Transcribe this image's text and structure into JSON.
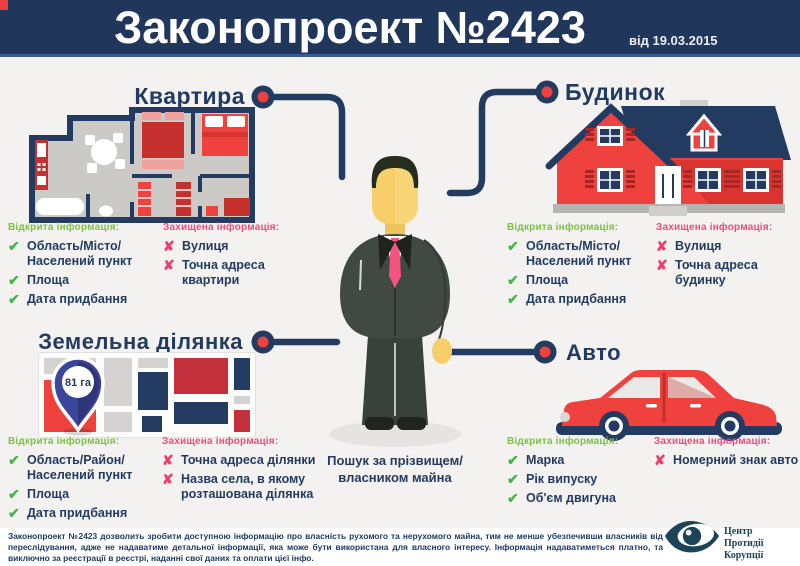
{
  "header": {
    "title": "Законопроект №2423",
    "date": "від 19.03.2015"
  },
  "sections": [
    {
      "id": "apartment",
      "title": "Квартира",
      "open_heading": "Відкрита інформація:",
      "open_items": [
        "Область/Місто/\nНаселений пункт",
        "Площа",
        "Дата придбання"
      ],
      "protected_heading": "Захищена інформація:",
      "protected_items": [
        "Вулиця",
        "Точна адреса квартири"
      ]
    },
    {
      "id": "house",
      "title": "Будинок",
      "open_heading": "Відкрита інформація:",
      "open_items": [
        "Область/Місто/\nНаселений пункт",
        "Площа",
        "Дата придбання"
      ],
      "protected_heading": "Захищена інформація:",
      "protected_items": [
        "Вулиця",
        "Точна адреса будинку"
      ]
    },
    {
      "id": "land",
      "title": "Земельна ділянка",
      "open_heading": "Відкрита інформація:",
      "open_items": [
        "Область/Район/\nНаселений пункт",
        "Площа",
        "Дата придбання"
      ],
      "protected_heading": "Захищена інформація:",
      "protected_items": [
        "Точна адреса ділянки",
        "Назва села, в якому\nрозташована ділянка"
      ]
    },
    {
      "id": "auto",
      "title": "Авто",
      "open_heading": "Відкрита інформація:",
      "open_items": [
        "Марка",
        "Рік випуску",
        "Об'єм двигуна"
      ],
      "protected_heading": "Захищена інформація:",
      "protected_items": [
        "Номерний знак авто"
      ]
    }
  ],
  "center": {
    "caption": "Пошук за прізвищем/\nвласником майна"
  },
  "land_map": {
    "pin_label": "81 га"
  },
  "icons": {
    "check": "✔",
    "cross": "✘",
    "logo": "eye-icon"
  },
  "footer": {
    "text": "Законопроект №2423 дозволить зробити доступною інформацію про власність рухомого та нерухомого майна, тим не менше убезпечивши власників від переслідування, адже не надаватиме детальної інформації, яка може бути використана для власного інтересу. Інформація надаватиметься платно, та виключно за реєстрації в реєстрі, наданні свої даних та оплати цієї інфо.",
    "logo_text": "Центр\nПротидії Корупції"
  },
  "colors": {
    "header_bg": "#21365b",
    "navy": "#233b61",
    "accent_red": "#ef413d",
    "open_green": "#7dc142",
    "check_green": "#45b649",
    "protected_pink": "#f04b7c",
    "background": "#f3f2f0"
  }
}
